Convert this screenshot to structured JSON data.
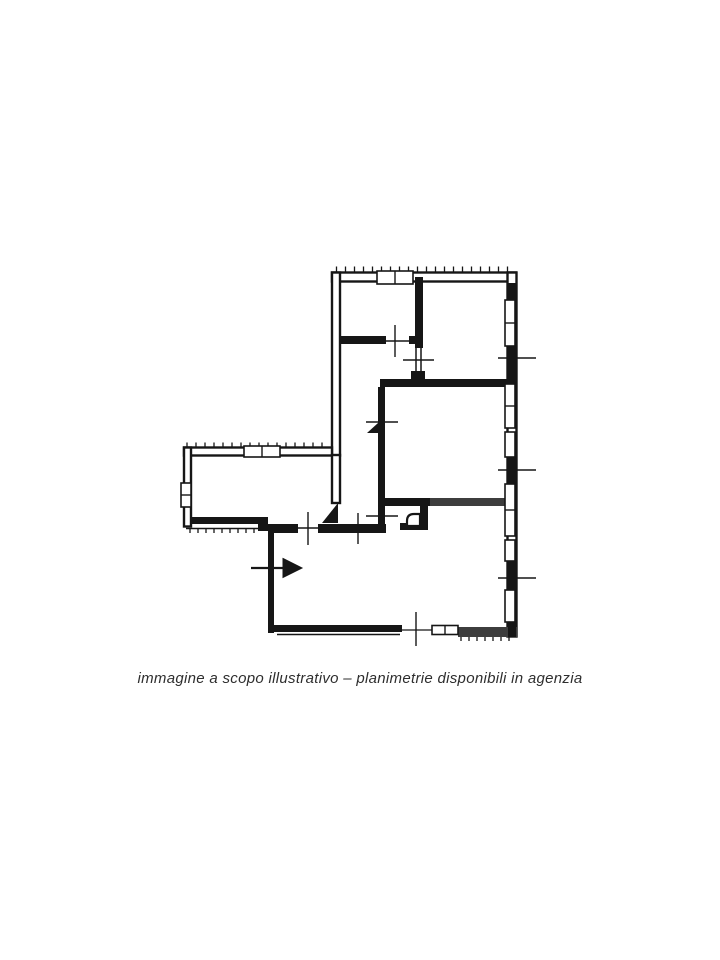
{
  "page": {
    "background": "#ffffff",
    "width": 720,
    "height": 960
  },
  "caption": {
    "text": "immagine a scopo illustrativo – planimetrie disponibili in agenzia",
    "color": "#2e2e2e"
  },
  "floorplan": {
    "ink": "#161616",
    "ink_light": "#3d3d3d",
    "paper": "#ffffff",
    "outlined_walls": [
      {
        "x": 332,
        "y": 272.5,
        "w": 184,
        "h": 9
      },
      {
        "x": 332,
        "y": 272.5,
        "w": 8,
        "h": 183
      },
      {
        "x": 507.5,
        "y": 272.5,
        "w": 9,
        "h": 364
      },
      {
        "x": 184,
        "y": 447.5,
        "w": 148,
        "h": 8
      },
      {
        "x": 184,
        "y": 447.5,
        "w": 7,
        "h": 79
      },
      {
        "x": 332,
        "y": 455,
        "w": 8,
        "h": 48
      }
    ],
    "solid_walls": [
      {
        "x": 415,
        "y": 277,
        "w": 8,
        "h": 71
      },
      {
        "x": 340,
        "y": 336,
        "w": 46,
        "h": 8
      },
      {
        "x": 409,
        "y": 336,
        "w": 12,
        "h": 8
      },
      {
        "x": 411,
        "y": 371,
        "w": 14,
        "h": 13
      },
      {
        "x": 380,
        "y": 379,
        "w": 128,
        "h": 8
      },
      {
        "x": 378,
        "y": 387,
        "w": 7,
        "h": 137
      },
      {
        "x": 382,
        "y": 498,
        "w": 48,
        "h": 8
      },
      {
        "x": 430,
        "y": 498,
        "w": 78,
        "h": 8,
        "c": "#3d3d3d"
      },
      {
        "x": 420,
        "y": 506,
        "w": 8,
        "h": 24
      },
      {
        "x": 400,
        "y": 523,
        "w": 28,
        "h": 7
      },
      {
        "x": 268,
        "y": 524,
        "w": 30,
        "h": 9
      },
      {
        "x": 318,
        "y": 524,
        "w": 68,
        "h": 9
      },
      {
        "x": 190,
        "y": 517,
        "w": 68,
        "h": 7
      },
      {
        "x": 258,
        "y": 517,
        "w": 10,
        "h": 14
      },
      {
        "x": 268,
        "y": 531,
        "w": 6,
        "h": 102
      },
      {
        "x": 273,
        "y": 625,
        "w": 129,
        "h": 7
      },
      {
        "x": 458,
        "y": 627,
        "w": 59,
        "h": 10,
        "c": "#3d3d3d"
      },
      {
        "x": 508,
        "y": 283,
        "w": 8,
        "h": 17
      },
      {
        "x": 508,
        "y": 346,
        "w": 8,
        "h": 38
      },
      {
        "x": 508,
        "y": 457,
        "w": 8,
        "h": 27
      },
      {
        "x": 508,
        "y": 561,
        "w": 8,
        "h": 29
      },
      {
        "x": 508,
        "y": 622,
        "w": 8,
        "h": 15
      }
    ],
    "thin_lines": [
      {
        "x1": 186,
        "y1": 528.5,
        "x2": 264,
        "y2": 528.5,
        "w": 1.5
      },
      {
        "x1": 277,
        "y1": 634.5,
        "x2": 400,
        "y2": 634.5,
        "w": 1.5
      },
      {
        "x1": 416,
        "y1": 346,
        "x2": 416,
        "y2": 372,
        "w": 1.5
      },
      {
        "x1": 421,
        "y1": 346,
        "x2": 421,
        "y2": 372,
        "w": 1.5
      },
      {
        "x1": 402,
        "y1": 630,
        "x2": 432,
        "y2": 630,
        "w": 1.3
      }
    ],
    "windows": [
      {
        "x": 377,
        "y": 271,
        "w": 36,
        "h": 13,
        "div": "v"
      },
      {
        "x": 244,
        "y": 446,
        "w": 36,
        "h": 11,
        "div": "v"
      },
      {
        "x": 181,
        "y": 483,
        "w": 10,
        "h": 24,
        "div": "h"
      },
      {
        "x": 505,
        "y": 300,
        "w": 10,
        "h": 46,
        "div": "h"
      },
      {
        "x": 505,
        "y": 384,
        "w": 10,
        "h": 44,
        "div": "h"
      },
      {
        "x": 505,
        "y": 432,
        "w": 10,
        "h": 25,
        "div": null
      },
      {
        "x": 505,
        "y": 484,
        "w": 10,
        "h": 52,
        "div": "h"
      },
      {
        "x": 505,
        "y": 540,
        "w": 10,
        "h": 21,
        "div": null
      },
      {
        "x": 505,
        "y": 590,
        "w": 10,
        "h": 32,
        "div": null
      },
      {
        "x": 432,
        "y": 625.5,
        "w": 26,
        "h": 9,
        "div": "v"
      }
    ],
    "opening_ticks": [
      {
        "x1": 395,
        "y1": 325,
        "x2": 395,
        "y2": 357
      },
      {
        "x1": 381,
        "y1": 341,
        "x2": 410,
        "y2": 341
      },
      {
        "x1": 403,
        "y1": 360,
        "x2": 434,
        "y2": 360
      },
      {
        "x1": 498,
        "y1": 358,
        "x2": 536,
        "y2": 358
      },
      {
        "x1": 498,
        "y1": 470,
        "x2": 536,
        "y2": 470
      },
      {
        "x1": 498,
        "y1": 578,
        "x2": 536,
        "y2": 578
      },
      {
        "x1": 366,
        "y1": 422,
        "x2": 398,
        "y2": 422
      },
      {
        "x1": 382,
        "y1": 407,
        "x2": 382,
        "y2": 438
      },
      {
        "x1": 366,
        "y1": 516,
        "x2": 398,
        "y2": 516
      },
      {
        "x1": 308,
        "y1": 512,
        "x2": 308,
        "y2": 545
      },
      {
        "x1": 293,
        "y1": 528,
        "x2": 322,
        "y2": 528
      },
      {
        "x1": 358,
        "y1": 513,
        "x2": 358,
        "y2": 544
      },
      {
        "x1": 416,
        "y1": 612,
        "x2": 416,
        "y2": 646
      }
    ],
    "hatch_groups": [
      {
        "x": 336.5,
        "y": 266.5,
        "step": 9,
        "count": 20,
        "len": 6
      },
      {
        "x": 187,
        "y": 442.5,
        "step": 9,
        "count": 16,
        "len": 6
      },
      {
        "x": 190,
        "y": 528,
        "step": 8,
        "count": 9,
        "len": 5
      },
      {
        "x": 461,
        "y": 636,
        "step": 8,
        "count": 7,
        "len": 5
      }
    ],
    "door_leaf_triangles": [
      "322,523 338,503 338,523",
      "367,433 378,423 378,433"
    ],
    "entrance_arrow": {
      "shaft": {
        "x1": 251,
        "y1": 568,
        "x2": 285,
        "y2": 568
      },
      "head": "283,558.5 302,568 283,577.5"
    },
    "door_jamb_path": "M407 526 V521 Q407 514 414 514 H420 V526 Z"
  }
}
